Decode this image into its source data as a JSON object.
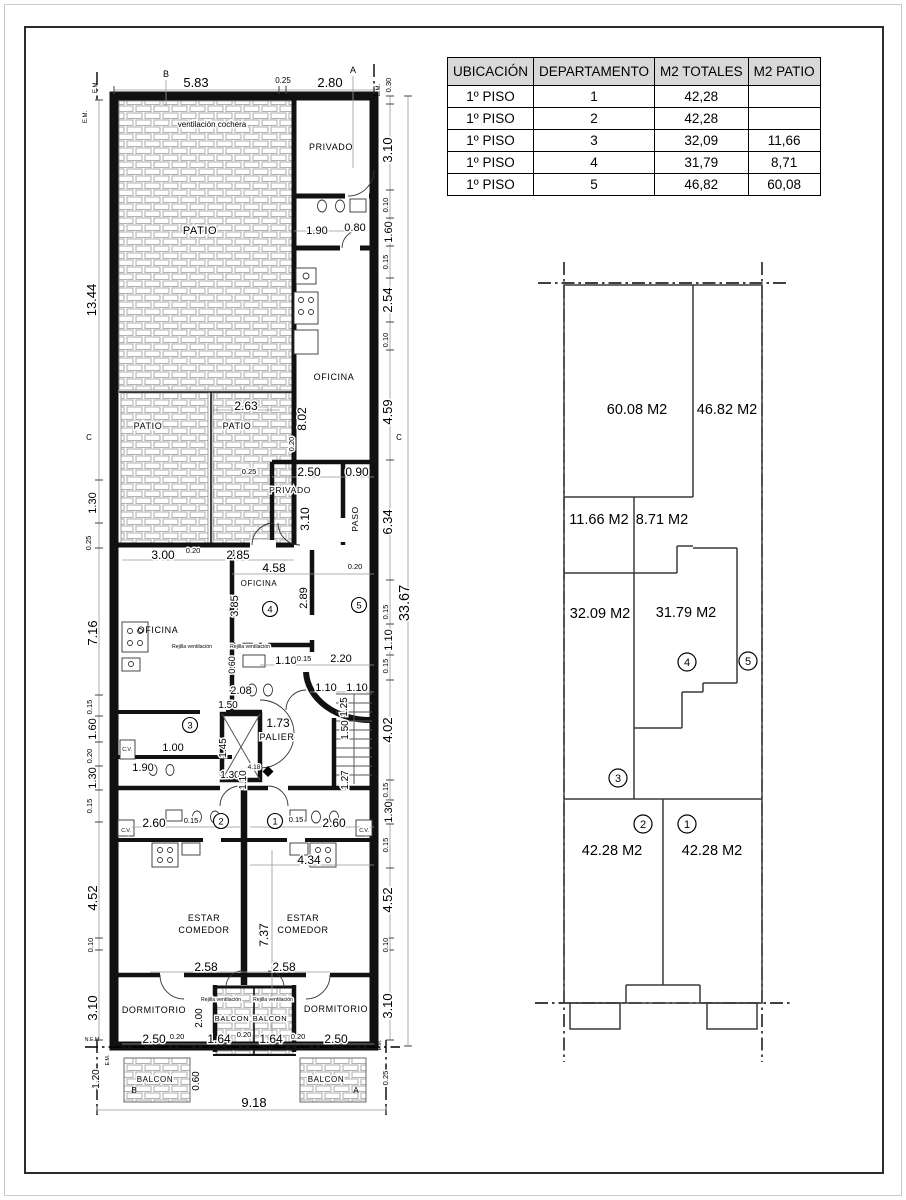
{
  "table": {
    "headers": [
      "UBICACIÓN",
      "DEPARTAMENTO",
      "M2 TOTALES",
      "M2 PATIO"
    ],
    "rows": [
      [
        "1º PISO",
        "1",
        "42,28",
        ""
      ],
      [
        "1º PISO",
        "2",
        "42,28",
        ""
      ],
      [
        "1º PISO",
        "3",
        "32,09",
        "11,66"
      ],
      [
        "1º PISO",
        "4",
        "31,79",
        "8,71"
      ],
      [
        "1º PISO",
        "5",
        "46,82",
        "60,08"
      ]
    ]
  },
  "units": [
    "1",
    "2",
    "3",
    "4",
    "5"
  ],
  "plan": {
    "rooms": {
      "vent": "ventilación cochera",
      "patio": "PATIO",
      "privado": "PRIVADO",
      "oficina": "OFICINA",
      "paso": "PASO",
      "palier": "PALIER",
      "estar": "ESTAR",
      "comedor": "COMEDOR",
      "dormitorio": "DORMITORIO",
      "balcon": "BALCON",
      "rejilla": "Rejilla ventilación",
      "cv": "C.V."
    },
    "top": [
      "5.83",
      "0.25",
      "2.80"
    ],
    "left": [
      "13.44",
      "1.30",
      "0.25",
      "7.16",
      "0.15",
      "1.60",
      "0.20",
      "1.30",
      "0.15",
      "4.52",
      "0.10",
      "3.10",
      "1.20"
    ],
    "right": [
      "0.30",
      "3.10",
      "0.10",
      "1.60",
      "0.15",
      "2.54",
      "0.10",
      "4.59",
      "6.34",
      "0.15",
      "1.10",
      "0.15",
      "4.02",
      "0.15",
      "1.30",
      "0.15",
      "4.52",
      "0.10",
      "3.10",
      "0.25",
      "33.67"
    ],
    "inner": [
      "1.90",
      "0.80",
      "2.63",
      "8.02",
      "0.20",
      "0.25",
      "2.50",
      "0.90",
      "3.10",
      "3.00",
      "0.20",
      "2.85",
      "4.58",
      "0.20",
      "3.85",
      "2.89",
      "1.10",
      "0.15",
      "2.20",
      "0.60",
      "2.08",
      "1.10",
      "1.10",
      "1.25",
      "1.50",
      "1.45",
      "1.30",
      "1.73",
      "1.00",
      "1.50",
      "1.27",
      "1.90",
      "4.18",
      "1.10",
      "2.60",
      "0.15",
      "0.15",
      "2.60",
      "4.34",
      "7.37",
      "2.58",
      "2.58",
      "2.00",
      "2.50",
      "0.20",
      "1.64",
      "0.20",
      "1.64",
      "0.20",
      "2.50",
      "0.60",
      "9.18"
    ],
    "markers": {
      "a": "A",
      "b": "B",
      "c": "C",
      "em": "E.M.",
      "nem": "N.E.M"
    }
  },
  "diagram": {
    "areas": [
      "60.08 M2",
      "46.82 M2",
      "11.66 M2",
      "8.71 M2",
      "32.09 M2",
      "31.79 M2",
      "42.28 M2",
      "42.28 M2"
    ]
  }
}
